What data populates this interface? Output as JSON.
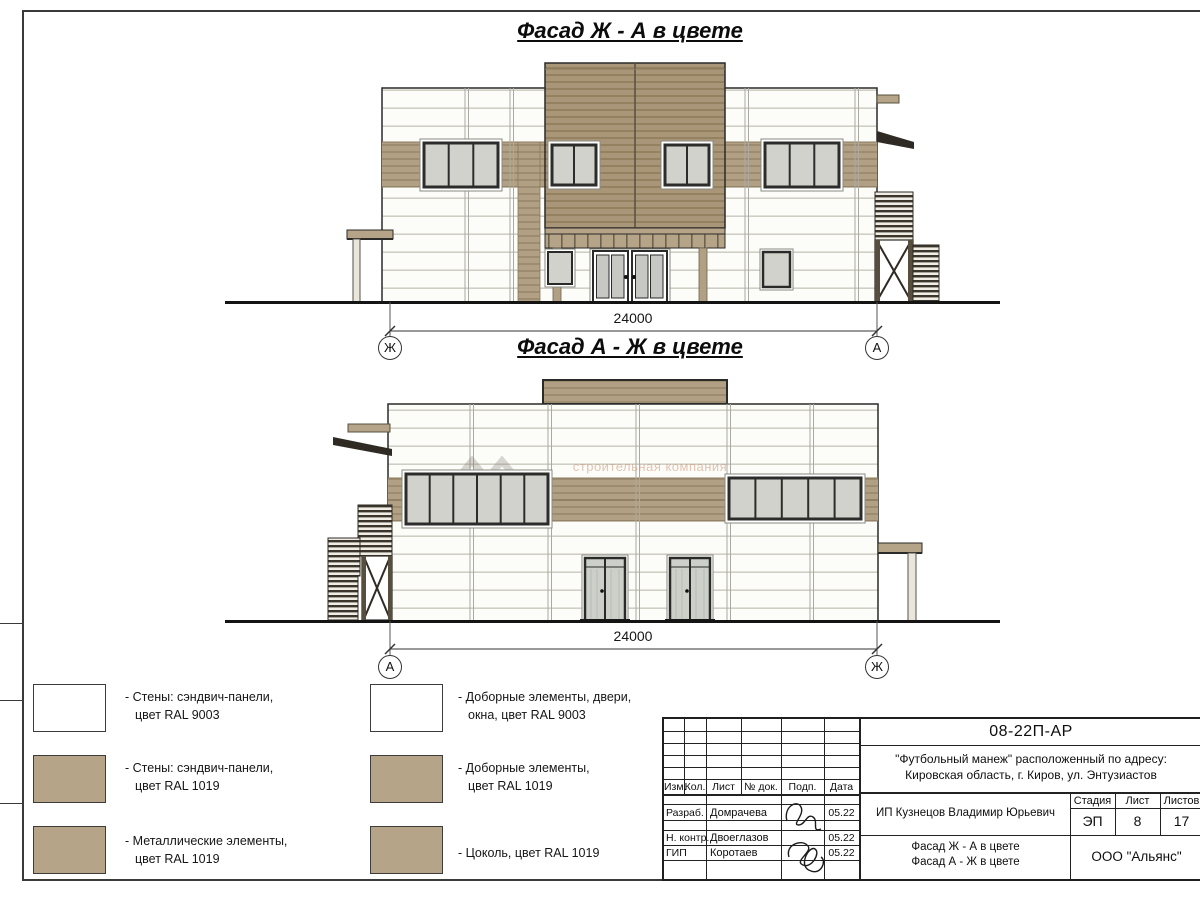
{
  "drawing": {
    "facade1": {
      "title": "Фасад Ж - А в цвете",
      "dimension": "24000",
      "axis_left": "Ж",
      "axis_right": "А"
    },
    "facade2": {
      "title": "Фасад А - Ж в цвете",
      "dimension": "24000",
      "axis_left": "А",
      "axis_right": "Ж"
    },
    "watermark": "строительная компания"
  },
  "colors": {
    "ral9003": "#ffffff",
    "ral1019": "#b6a488"
  },
  "legend": {
    "items": [
      {
        "swatch": "#ffffff",
        "line1": "- Стены: сэндвич-панели,",
        "line2": "цвет RAL 9003"
      },
      {
        "swatch": "#b6a488",
        "line1": "- Стены: сэндвич-панели,",
        "line2": "цвет RAL 1019"
      },
      {
        "swatch": "#b6a488",
        "line1": "- Металлические элементы,",
        "line2": "цвет RAL 1019"
      },
      {
        "swatch": "#ffffff",
        "line1": "- Доборные элементы, двери,",
        "line2": "окна, цвет RAL 9003"
      },
      {
        "swatch": "#b6a488",
        "line1": "- Доборные элементы,",
        "line2": "цвет RAL 1019"
      },
      {
        "swatch": "#b6a488",
        "line1": "- Цоколь, цвет RAL 1019",
        "line2": ""
      }
    ]
  },
  "title_block": {
    "doc_number": "08-22П-АР",
    "project_line1": "\"Футбольный манеж\" расположенный по адресу:",
    "project_line2": "Кировская область, г. Киров, ул. Энтузиастов",
    "col_izm": "Изм.",
    "col_kol": "Кол.",
    "col_list": "Лист",
    "col_doc": "№ док.",
    "col_podp": "Подп.",
    "col_data": "Дата",
    "rows": [
      {
        "role": "Разраб.",
        "name": "Домрачева",
        "date": "05.22"
      },
      {
        "role": "Н. контр.",
        "name": "Двоеглазов",
        "date": "05.22"
      },
      {
        "role": "ГИП",
        "name": "Коротаев",
        "date": "05.22"
      }
    ],
    "client": "ИП Кузнецов Владимир Юрьевич",
    "stage_label": "Стадия",
    "sheet_label": "Лист",
    "sheets_label": "Листов",
    "stage": "ЭП",
    "sheet": "8",
    "sheets": "17",
    "sheet_title_line1": "Фасад Ж - А в цвете",
    "sheet_title_line2": "Фасад А - Ж в цвете",
    "company": "ООО \"Альянс\""
  }
}
